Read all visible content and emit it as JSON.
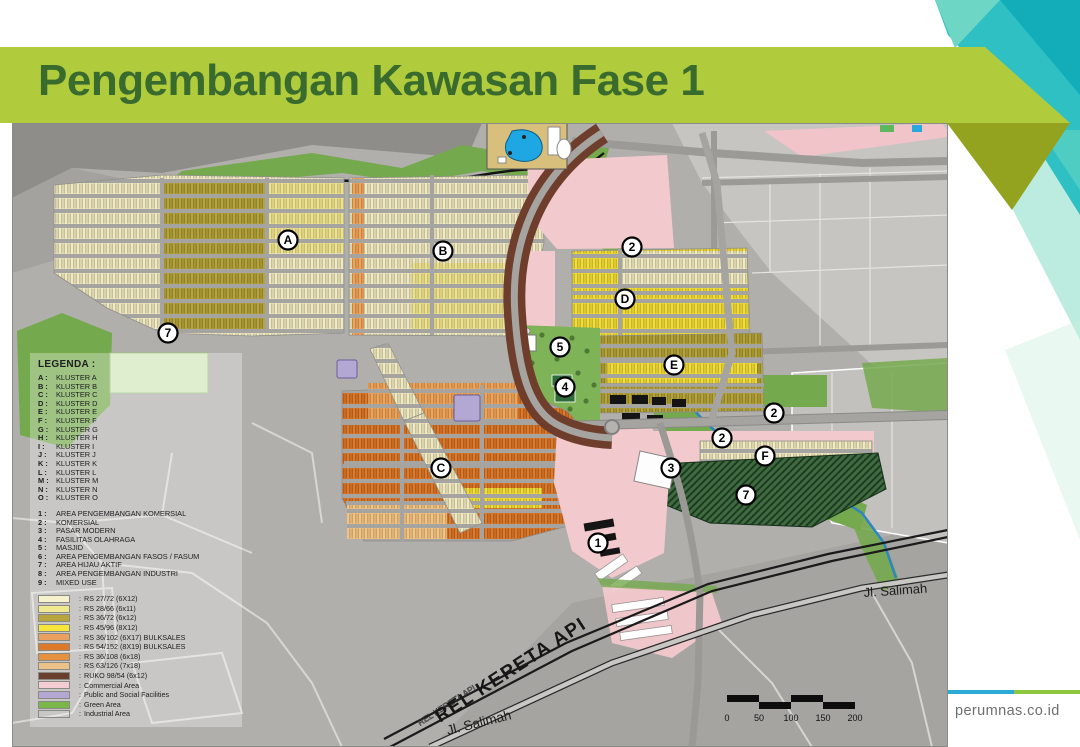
{
  "slide": {
    "title": "Pengembangan Kawasan Fase 1",
    "website": "perumnas.co.id"
  },
  "colors": {
    "banner_green": "#b0cb3c",
    "banner_shadow_olive": "#93a320",
    "title_text": "#3a6b2e",
    "teal_accent": "#2fc0c4",
    "footer_blue": "#2aabd6",
    "footer_green": "#8ec63f",
    "commercial_pink": "#f2c9cd",
    "public_lavender": "#b3a7d4",
    "green_area": "#74a94e",
    "ruko_brown": "#6f3d2b"
  },
  "legend": {
    "title": "LEGENDA :",
    "clusters": [
      {
        "key": "A :",
        "label": "KLUSTER A"
      },
      {
        "key": "B :",
        "label": "KLUSTER B"
      },
      {
        "key": "C :",
        "label": "KLUSTER C"
      },
      {
        "key": "D :",
        "label": "KLUSTER D"
      },
      {
        "key": "E :",
        "label": "KLUSTER E"
      },
      {
        "key": "F :",
        "label": "KLUSTER F"
      },
      {
        "key": "G :",
        "label": "KLUSTER G"
      },
      {
        "key": "H :",
        "label": "KLUSTER H"
      },
      {
        "key": "I :",
        "label": "KLUSTER I"
      },
      {
        "key": "J :",
        "label": "KLUSTER J"
      },
      {
        "key": "K :",
        "label": "KLUSTER K"
      },
      {
        "key": "L :",
        "label": "KLUSTER L"
      },
      {
        "key": "M :",
        "label": "KLUSTER M"
      },
      {
        "key": "N :",
        "label": "KLUSTER N"
      },
      {
        "key": "O :",
        "label": "KLUSTER O"
      }
    ],
    "facilities": [
      {
        "key": "1 :",
        "label": "AREA PENGEMBANGAN KOMERSIAL"
      },
      {
        "key": "2 :",
        "label": "KOMERSIAL"
      },
      {
        "key": "3 :",
        "label": "PASAR MODERN"
      },
      {
        "key": "4 :",
        "label": "FASILITAS OLAHRAGA"
      },
      {
        "key": "5 :",
        "label": "MASJID"
      },
      {
        "key": "6 :",
        "label": "AREA PENGEMBANGAN FASOS / FASUM"
      },
      {
        "key": "7 :",
        "label": "AREA HIJAU AKTIF"
      },
      {
        "key": "8 :",
        "label": "AREA PENGEMBANGAN INDUSTRI"
      },
      {
        "key": "9 :",
        "label": "MIXED USE"
      }
    ],
    "unit_types": [
      {
        "label": "RS 27/72 (6X12)",
        "color": "#f5f2cd"
      },
      {
        "label": "RS 28/66 (6x11)",
        "color": "#f0e98f"
      },
      {
        "label": "RS 36/72 (6x12)",
        "color": "#b9a53e"
      },
      {
        "label": "RS 45/96 (8X12)",
        "color": "#f6e53a"
      },
      {
        "label": "RS 36/102 (6X17) BULKSALES",
        "color": "#eaa061"
      },
      {
        "label": "RS 54/152 (8X19) BULKSALES",
        "color": "#dd7a2a"
      },
      {
        "label": "RS 36/108 (6x18)",
        "color": "#e6913f"
      },
      {
        "label": "RS 63/126 (7x18)",
        "color": "#edc289"
      },
      {
        "label": "RUKO 98/54 (6x12)",
        "color": "#6a3f2e"
      },
      {
        "label": "Commercial Area",
        "color": "#f4cdd2"
      },
      {
        "label": "Public and Social Facilities",
        "color": "#b4a8d3"
      },
      {
        "label": "Green Area",
        "color": "#7ab648"
      },
      {
        "label": "Industrial Area",
        "color": "#ececе6"
      }
    ]
  },
  "map": {
    "markers": [
      {
        "label": "A",
        "x": 276,
        "y": 117
      },
      {
        "label": "B",
        "x": 431,
        "y": 128
      },
      {
        "label": "C",
        "x": 429,
        "y": 345
      },
      {
        "label": "D",
        "x": 613,
        "y": 176
      },
      {
        "label": "E",
        "x": 662,
        "y": 242
      },
      {
        "label": "F",
        "x": 753,
        "y": 333
      },
      {
        "label": "1",
        "x": 586,
        "y": 420
      },
      {
        "label": "2",
        "x": 620,
        "y": 124
      },
      {
        "label": "2",
        "x": 762,
        "y": 290
      },
      {
        "label": "2",
        "x": 710,
        "y": 315
      },
      {
        "label": "3",
        "x": 659,
        "y": 345
      },
      {
        "label": "4",
        "x": 553,
        "y": 264
      },
      {
        "label": "5",
        "x": 548,
        "y": 224
      },
      {
        "label": "7",
        "x": 156,
        "y": 210
      },
      {
        "label": "7",
        "x": 734,
        "y": 372
      }
    ],
    "road_labels": {
      "salimah_right": "Jl. Salimah",
      "salimah_bottom": "Jl. Salimah",
      "railway": "REL KERETA API",
      "railway_small": "REL KERETA API"
    },
    "scale_ticks": [
      "0",
      "50",
      "100",
      "150",
      "200"
    ]
  }
}
